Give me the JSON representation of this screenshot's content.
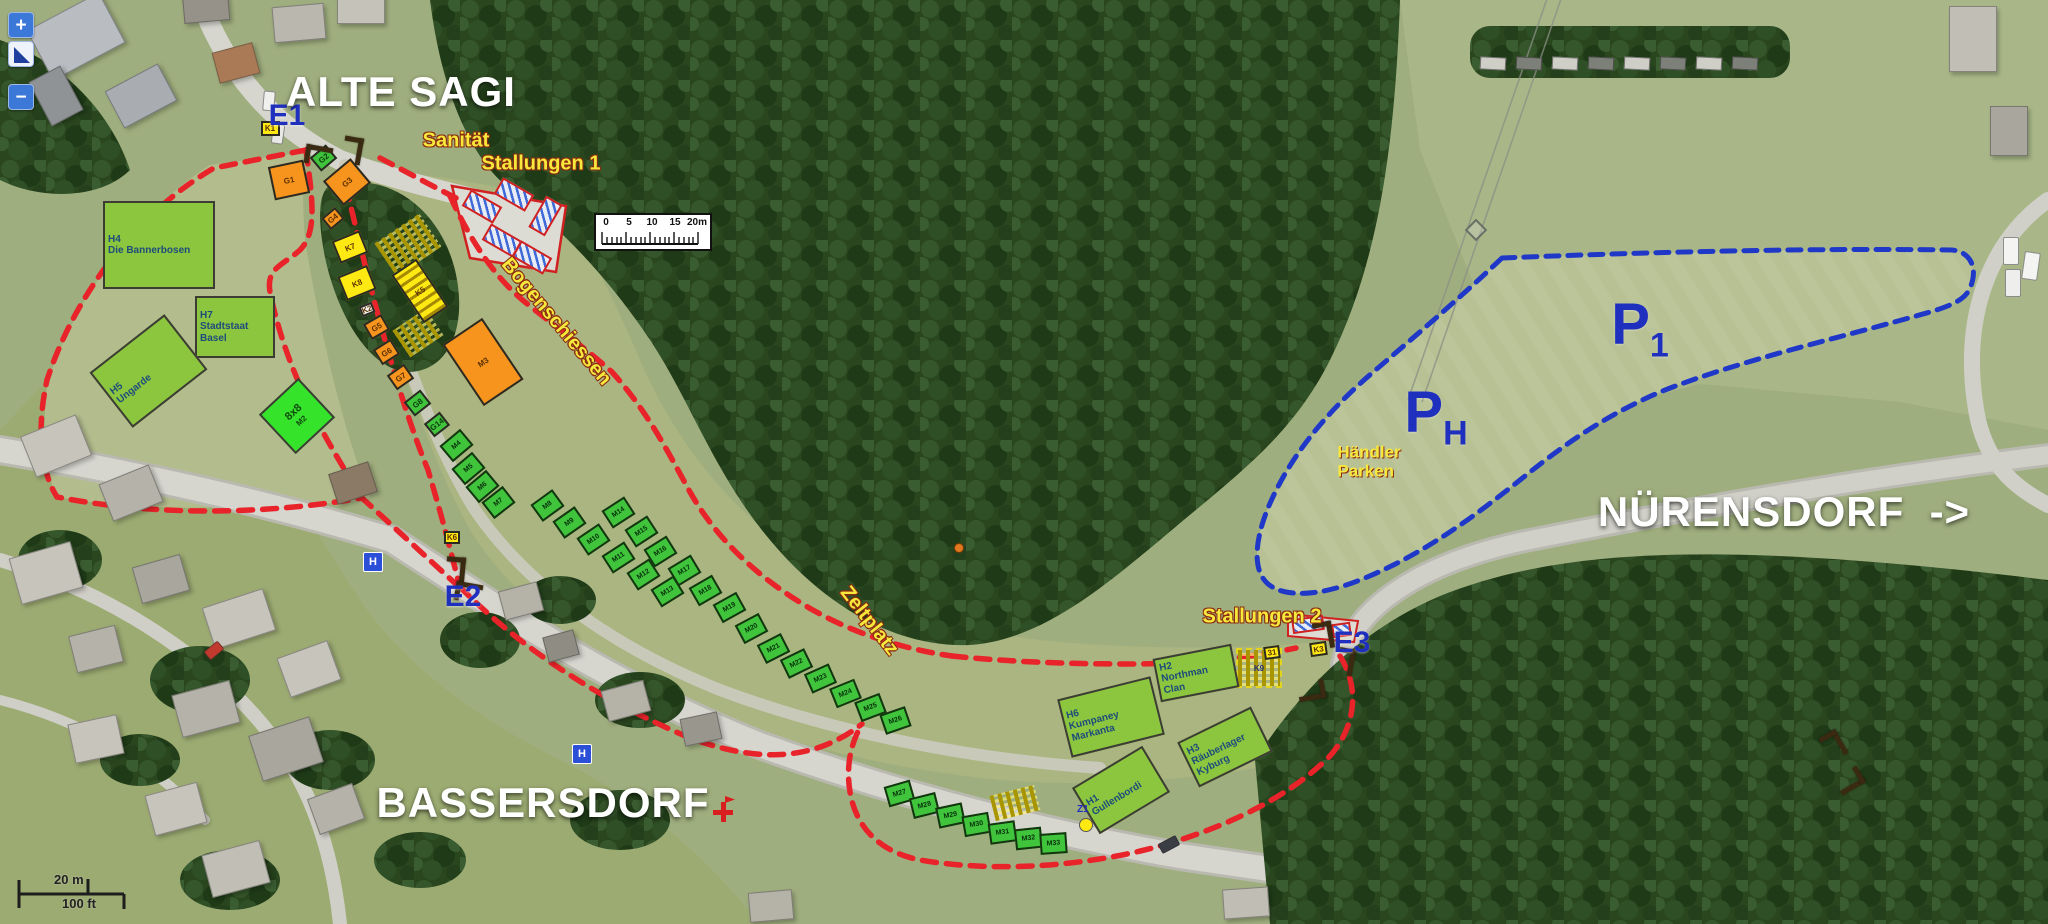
{
  "controls": {
    "zoom_in": "+",
    "zoom_out": "−",
    "pan_icon": "pan-extent-triangle"
  },
  "scale_top": {
    "ticks": [
      "0",
      "5",
      "10",
      "15",
      "20m"
    ]
  },
  "scale_bottom": {
    "m": "20 m",
    "ft": "100 ft"
  },
  "colors": {
    "red_boundary": "#e8232a",
    "blue_boundary": "#2038c8",
    "camp_green": "#8cc63e",
    "stall_green": "#3fc43c",
    "stand_orange": "#f7941e",
    "stand_yellow": "#ffe913",
    "label_yellow": "#f7e93c",
    "label_blue": "#1f2fbe",
    "label_white": "#ffffff"
  },
  "place_labels": [
    {
      "text": "ALTE SAGI",
      "cx": 401,
      "cy": 92
    },
    {
      "text": "BASSERSDORF",
      "cx": 543,
      "cy": 803
    },
    {
      "text": "NÜRENSDORF  ->",
      "cx": 1784,
      "cy": 512
    }
  ],
  "parking_labels": [
    {
      "letter": "P",
      "sub": "1",
      "cx": 1640,
      "cy": 328
    },
    {
      "letter": "P",
      "sub": "H",
      "cx": 1436,
      "cy": 416
    }
  ],
  "handler_label": {
    "text": "Händler\nParken",
    "cx": 1369,
    "cy": 462
  },
  "site_labels": [
    {
      "text": "Sanität",
      "cx": 456,
      "cy": 141,
      "rot": 0
    },
    {
      "text": "Stallungen 1",
      "cx": 541,
      "cy": 164,
      "rot": 0
    },
    {
      "text": "Stallungen 2",
      "cx": 1262,
      "cy": 617,
      "rot": 0
    },
    {
      "text": "Bogenschiessen",
      "cx": 556,
      "cy": 322,
      "rot": 50
    },
    {
      "text": "Zeltplatz",
      "cx": 869,
      "cy": 621,
      "rot": 52
    }
  ],
  "entrance_labels": [
    {
      "text": "E1",
      "cx": 287,
      "cy": 116
    },
    {
      "text": "E2",
      "cx": 463,
      "cy": 597
    },
    {
      "text": "E3",
      "cx": 1352,
      "cy": 643
    }
  ],
  "camps": [
    {
      "id": "H4",
      "name": "Die Bannerbosen",
      "cx": 159,
      "cy": 245,
      "w": 112,
      "h": 88,
      "rot": 0
    },
    {
      "id": "H7",
      "name": "Stadtstaat Basel",
      "cx": 235,
      "cy": 327,
      "w": 80,
      "h": 62,
      "rot": 0
    },
    {
      "id": "H5",
      "name": "Ungarde",
      "cx": 148,
      "cy": 371,
      "w": 95,
      "h": 70,
      "rot": -38
    },
    {
      "id": "8x8",
      "name": "M2",
      "cx": 297,
      "cy": 416,
      "w": 54,
      "h": 54,
      "rot": -43,
      "bright": true
    },
    {
      "id": "H6",
      "name": "Kumpaney Markanta",
      "cx": 1111,
      "cy": 717,
      "w": 96,
      "h": 60,
      "rot": -14
    },
    {
      "id": "H2",
      "name": "Northman Clan",
      "cx": 1196,
      "cy": 673,
      "w": 80,
      "h": 44,
      "rot": -11
    },
    {
      "id": "H3",
      "name": "Räuberlager Kyburg",
      "cx": 1225,
      "cy": 747,
      "w": 82,
      "h": 50,
      "rot": -26
    },
    {
      "id": "H1",
      "name": "Gullenbordi",
      "cx": 1121,
      "cy": 790,
      "w": 82,
      "h": 54,
      "rot": -31
    }
  ],
  "stands": [
    {
      "label": "K1",
      "cx": 270,
      "cy": 128,
      "w": 19,
      "h": 15,
      "rot": 0,
      "type": "yellow"
    },
    {
      "label": "G1",
      "cx": 289,
      "cy": 180,
      "w": 36,
      "h": 34,
      "rot": -12,
      "type": "orange"
    },
    {
      "label": "G2",
      "cx": 323,
      "cy": 158,
      "w": 21,
      "h": 18,
      "rot": -40,
      "type": "green"
    },
    {
      "label": "G3",
      "cx": 347,
      "cy": 182,
      "w": 36,
      "h": 32,
      "rot": -40,
      "type": "orange"
    },
    {
      "label": "G4",
      "cx": 333,
      "cy": 218,
      "w": 18,
      "h": 15,
      "rot": -40,
      "type": "orange"
    },
    {
      "label": "K7",
      "cx": 350,
      "cy": 247,
      "w": 30,
      "h": 24,
      "rot": -22,
      "type": "yellow"
    },
    {
      "label": "K8",
      "cx": 357,
      "cy": 283,
      "w": 32,
      "h": 26,
      "rot": -22,
      "type": "yellow"
    },
    {
      "label": "K2",
      "cx": 367,
      "cy": 309,
      "w": 14,
      "h": 11,
      "rot": -22,
      "type": "white"
    },
    {
      "label": "G5",
      "cx": 376,
      "cy": 327,
      "w": 21,
      "h": 18,
      "rot": -30,
      "type": "orange"
    },
    {
      "label": "G6",
      "cx": 386,
      "cy": 352,
      "w": 21,
      "h": 18,
      "rot": -32,
      "type": "orange"
    },
    {
      "label": "G7",
      "cx": 400,
      "cy": 377,
      "w": 21,
      "h": 18,
      "rot": -35,
      "type": "orange"
    },
    {
      "label": "G8",
      "cx": 417,
      "cy": 403,
      "w": 21,
      "h": 18,
      "rot": -38,
      "type": "green"
    },
    {
      "label": "G14",
      "cx": 437,
      "cy": 424,
      "w": 20,
      "h": 17,
      "rot": -38,
      "type": "green"
    },
    {
      "label": "K5",
      "cx": 420,
      "cy": 291,
      "w": 30,
      "h": 58,
      "rot": -34,
      "type": "hatch"
    },
    {
      "label": "M3",
      "cx": 483,
      "cy": 362,
      "w": 48,
      "h": 74,
      "rot": -34,
      "type": "orange"
    },
    {
      "label": "K6",
      "cx": 452,
      "cy": 537,
      "w": 16,
      "h": 13,
      "rot": 0,
      "type": "yellow"
    },
    {
      "label": "31",
      "cx": 1272,
      "cy": 652,
      "w": 16,
      "h": 13,
      "rot": -8,
      "type": "yellow"
    },
    {
      "label": "K3",
      "cx": 1318,
      "cy": 649,
      "w": 17,
      "h": 14,
      "rot": -8,
      "type": "yellow"
    }
  ],
  "stalls": [
    {
      "label": "M4",
      "cx": 456,
      "cy": 445,
      "rot": -40
    },
    {
      "label": "M5",
      "cx": 468,
      "cy": 468,
      "rot": -40
    },
    {
      "label": "M6",
      "cx": 482,
      "cy": 486,
      "rot": -40
    },
    {
      "label": "M7",
      "cx": 498,
      "cy": 502,
      "rot": -38
    },
    {
      "label": "M8",
      "cx": 547,
      "cy": 505,
      "rot": -36
    },
    {
      "label": "M9",
      "cx": 569,
      "cy": 522,
      "rot": -35
    },
    {
      "label": "M10",
      "cx": 593,
      "cy": 539,
      "rot": -34
    },
    {
      "label": "M11",
      "cx": 618,
      "cy": 557,
      "rot": -33
    },
    {
      "label": "M12",
      "cx": 643,
      "cy": 574,
      "rot": -33
    },
    {
      "label": "M13",
      "cx": 667,
      "cy": 591,
      "rot": -32
    },
    {
      "label": "M14",
      "cx": 618,
      "cy": 512,
      "rot": -33
    },
    {
      "label": "M15",
      "cx": 641,
      "cy": 531,
      "rot": -33
    },
    {
      "label": "M16",
      "cx": 660,
      "cy": 551,
      "rot": -32
    },
    {
      "label": "M17",
      "cx": 684,
      "cy": 570,
      "rot": -31
    },
    {
      "label": "M18",
      "cx": 705,
      "cy": 590,
      "rot": -30
    },
    {
      "label": "M19",
      "cx": 729,
      "cy": 607,
      "rot": -29
    },
    {
      "label": "M20",
      "cx": 751,
      "cy": 628,
      "rot": -28
    },
    {
      "label": "M21",
      "cx": 773,
      "cy": 648,
      "rot": -27
    },
    {
      "label": "M22",
      "cx": 796,
      "cy": 663,
      "rot": -26
    },
    {
      "label": "M23",
      "cx": 820,
      "cy": 678,
      "rot": -24
    },
    {
      "label": "M24",
      "cx": 845,
      "cy": 693,
      "rot": -22
    },
    {
      "label": "M25",
      "cx": 870,
      "cy": 707,
      "rot": -21
    },
    {
      "label": "M26",
      "cx": 895,
      "cy": 720,
      "rot": -19
    },
    {
      "label": "M27",
      "cx": 899,
      "cy": 793,
      "rot": -16
    },
    {
      "label": "M28",
      "cx": 924,
      "cy": 805,
      "rot": -14
    },
    {
      "label": "M29",
      "cx": 950,
      "cy": 815,
      "rot": -12
    },
    {
      "label": "M30",
      "cx": 976,
      "cy": 824,
      "rot": -10
    },
    {
      "label": "M31",
      "cx": 1002,
      "cy": 832,
      "rot": -8
    },
    {
      "label": "M32",
      "cx": 1028,
      "cy": 838,
      "rot": -6
    },
    {
      "label": "M33",
      "cx": 1053,
      "cy": 843,
      "rot": -4
    }
  ],
  "benches": [
    {
      "cx": 408,
      "cy": 245,
      "w": 54,
      "h": 40,
      "rot": -34,
      "label": ""
    },
    {
      "cx": 418,
      "cy": 333,
      "w": 40,
      "h": 32,
      "rot": -34,
      "label": ""
    },
    {
      "cx": 1259,
      "cy": 668,
      "w": 42,
      "h": 36,
      "rot": 0,
      "label": "K9",
      "dashed": true
    },
    {
      "cx": 1015,
      "cy": 803,
      "w": 46,
      "h": 26,
      "rot": -14,
      "label": ""
    }
  ],
  "stables": [
    {
      "cx": 482,
      "cy": 206,
      "w": 36,
      "h": 19,
      "rot": 30
    },
    {
      "cx": 514,
      "cy": 194,
      "w": 36,
      "h": 19,
      "rot": 30
    },
    {
      "cx": 545,
      "cy": 216,
      "w": 19,
      "h": 36,
      "rot": 30
    },
    {
      "cx": 502,
      "cy": 240,
      "w": 36,
      "h": 19,
      "rot": 30
    },
    {
      "cx": 532,
      "cy": 257,
      "w": 36,
      "h": 19,
      "rot": 30
    },
    {
      "cx": 1308,
      "cy": 624,
      "w": 32,
      "h": 15,
      "rot": -8
    },
    {
      "cx": 1341,
      "cy": 630,
      "w": 19,
      "h": 14,
      "rot": -8
    }
  ],
  "barriers": [
    {
      "cx": 318,
      "cy": 155,
      "rot": 10
    },
    {
      "cx": 352,
      "cy": 150,
      "rot": 100
    },
    {
      "cx": 455,
      "cy": 570,
      "rot": 95
    },
    {
      "cx": 468,
      "cy": 592,
      "rot": 10
    },
    {
      "cx": 1323,
      "cy": 635,
      "rot": 80
    },
    {
      "cx": 1344,
      "cy": 661,
      "rot": 100
    },
    {
      "cx": 1311,
      "cy": 690,
      "rot": 170
    },
    {
      "cx": 1833,
      "cy": 745,
      "rot": 60
    },
    {
      "cx": 1849,
      "cy": 780,
      "rot": 150
    }
  ],
  "markers": {
    "bus_stops": [
      {
        "cx": 372,
        "cy": 561
      },
      {
        "cx": 581,
        "cy": 753
      }
    ],
    "red_cross": {
      "cx": 723,
      "cy": 812
    },
    "z_marker": {
      "label": "Z1",
      "cx": 1085,
      "cy": 824
    },
    "orange_dot": {
      "cx": 958,
      "cy": 547
    }
  },
  "buildings": [
    {
      "cx": 75,
      "cy": 35,
      "w": 80,
      "h": 55,
      "rot": -28,
      "fill": "#b9bdc2"
    },
    {
      "cx": 140,
      "cy": 95,
      "w": 58,
      "h": 40,
      "rot": -28,
      "fill": "#a9adb2"
    },
    {
      "cx": 55,
      "cy": 95,
      "w": 34,
      "h": 48,
      "rot": -28,
      "fill": "#8f9396"
    },
    {
      "cx": 235,
      "cy": 62,
      "w": 40,
      "h": 30,
      "rot": -15,
      "fill": "#a97a55"
    },
    {
      "cx": 298,
      "cy": 22,
      "w": 50,
      "h": 34,
      "rot": -5,
      "fill": "#b9b7ae"
    },
    {
      "cx": 360,
      "cy": 8,
      "w": 46,
      "h": 28,
      "rot": 0,
      "fill": "#c4c2b9"
    },
    {
      "cx": 205,
      "cy": 5,
      "w": 44,
      "h": 30,
      "rot": -5,
      "fill": "#96928a"
    },
    {
      "cx": 352,
      "cy": 482,
      "w": 40,
      "h": 30,
      "rot": -18,
      "fill": "#8a7a66"
    },
    {
      "cx": 520,
      "cy": 600,
      "w": 38,
      "h": 28,
      "rot": -15,
      "fill": "#b5b2a8"
    },
    {
      "cx": 560,
      "cy": 645,
      "w": 30,
      "h": 24,
      "rot": -15,
      "fill": "#8f8c84"
    },
    {
      "cx": 625,
      "cy": 700,
      "w": 42,
      "h": 30,
      "rot": -15,
      "fill": "#b5b2a8"
    },
    {
      "cx": 700,
      "cy": 728,
      "w": 36,
      "h": 26,
      "rot": -12,
      "fill": "#99968e"
    },
    {
      "cx": 770,
      "cy": 905,
      "w": 42,
      "h": 28,
      "rot": -5,
      "fill": "#b5b2a8"
    },
    {
      "cx": 1245,
      "cy": 902,
      "w": 44,
      "h": 28,
      "rot": -4,
      "fill": "#c0bdb4"
    },
    {
      "cx": 55,
      "cy": 445,
      "w": 58,
      "h": 42,
      "rot": -22,
      "fill": "#c6c4bb"
    },
    {
      "cx": 130,
      "cy": 492,
      "w": 52,
      "h": 38,
      "rot": -22,
      "fill": "#b4b2a9"
    },
    {
      "cx": 45,
      "cy": 572,
      "w": 62,
      "h": 46,
      "rot": -16,
      "fill": "#c6c4bb"
    },
    {
      "cx": 160,
      "cy": 578,
      "w": 48,
      "h": 36,
      "rot": -16,
      "fill": "#a8a69d"
    },
    {
      "cx": 238,
      "cy": 618,
      "w": 62,
      "h": 42,
      "rot": -18,
      "fill": "#c6c4bb"
    },
    {
      "cx": 95,
      "cy": 648,
      "w": 46,
      "h": 36,
      "rot": -14,
      "fill": "#b4b2a9"
    },
    {
      "cx": 308,
      "cy": 668,
      "w": 52,
      "h": 40,
      "rot": -20,
      "fill": "#c6c4bb"
    },
    {
      "cx": 205,
      "cy": 708,
      "w": 58,
      "h": 42,
      "rot": -15,
      "fill": "#b4b2a9"
    },
    {
      "cx": 95,
      "cy": 738,
      "w": 48,
      "h": 38,
      "rot": -12,
      "fill": "#c6c4bb"
    },
    {
      "cx": 285,
      "cy": 748,
      "w": 62,
      "h": 46,
      "rot": -18,
      "fill": "#a8a69d"
    },
    {
      "cx": 175,
      "cy": 808,
      "w": 52,
      "h": 40,
      "rot": -15,
      "fill": "#c6c4bb"
    },
    {
      "cx": 335,
      "cy": 808,
      "w": 46,
      "h": 36,
      "rot": -20,
      "fill": "#b4b2a9"
    },
    {
      "cx": 235,
      "cy": 868,
      "w": 58,
      "h": 42,
      "rot": -15,
      "fill": "#c0beb5"
    },
    {
      "cx": 1972,
      "cy": 38,
      "w": 46,
      "h": 64,
      "rot": 0,
      "fill": "#c0beb5"
    },
    {
      "cx": 2008,
      "cy": 130,
      "w": 36,
      "h": 48,
      "rot": 0,
      "fill": "#a8a69d"
    }
  ],
  "cars": [
    {
      "cx": 268,
      "cy": 100,
      "w": 10,
      "h": 18,
      "rot": 5,
      "fill": "#f0f0ee"
    },
    {
      "cx": 277,
      "cy": 133,
      "w": 10,
      "h": 18,
      "rot": 8,
      "fill": "#e8e8e6"
    },
    {
      "cx": 213,
      "cy": 649,
      "w": 16,
      "h": 9,
      "rot": -40,
      "fill": "#c23a2e"
    },
    {
      "cx": 1168,
      "cy": 843,
      "w": 18,
      "h": 9,
      "rot": -28,
      "fill": "#3a3d44"
    },
    {
      "cx": 2010,
      "cy": 250,
      "w": 14,
      "h": 26,
      "rot": 0,
      "fill": "#f4f4f2"
    },
    {
      "cx": 2012,
      "cy": 282,
      "w": 14,
      "h": 26,
      "rot": 0,
      "fill": "#eeeeec"
    },
    {
      "cx": 2030,
      "cy": 265,
      "w": 14,
      "h": 26,
      "rot": 8,
      "fill": "#f4f4f2"
    }
  ],
  "trailers": {
    "count": 8,
    "x0": 1492,
    "y": 62,
    "dx": 36,
    "w": 24,
    "h": 11
  }
}
